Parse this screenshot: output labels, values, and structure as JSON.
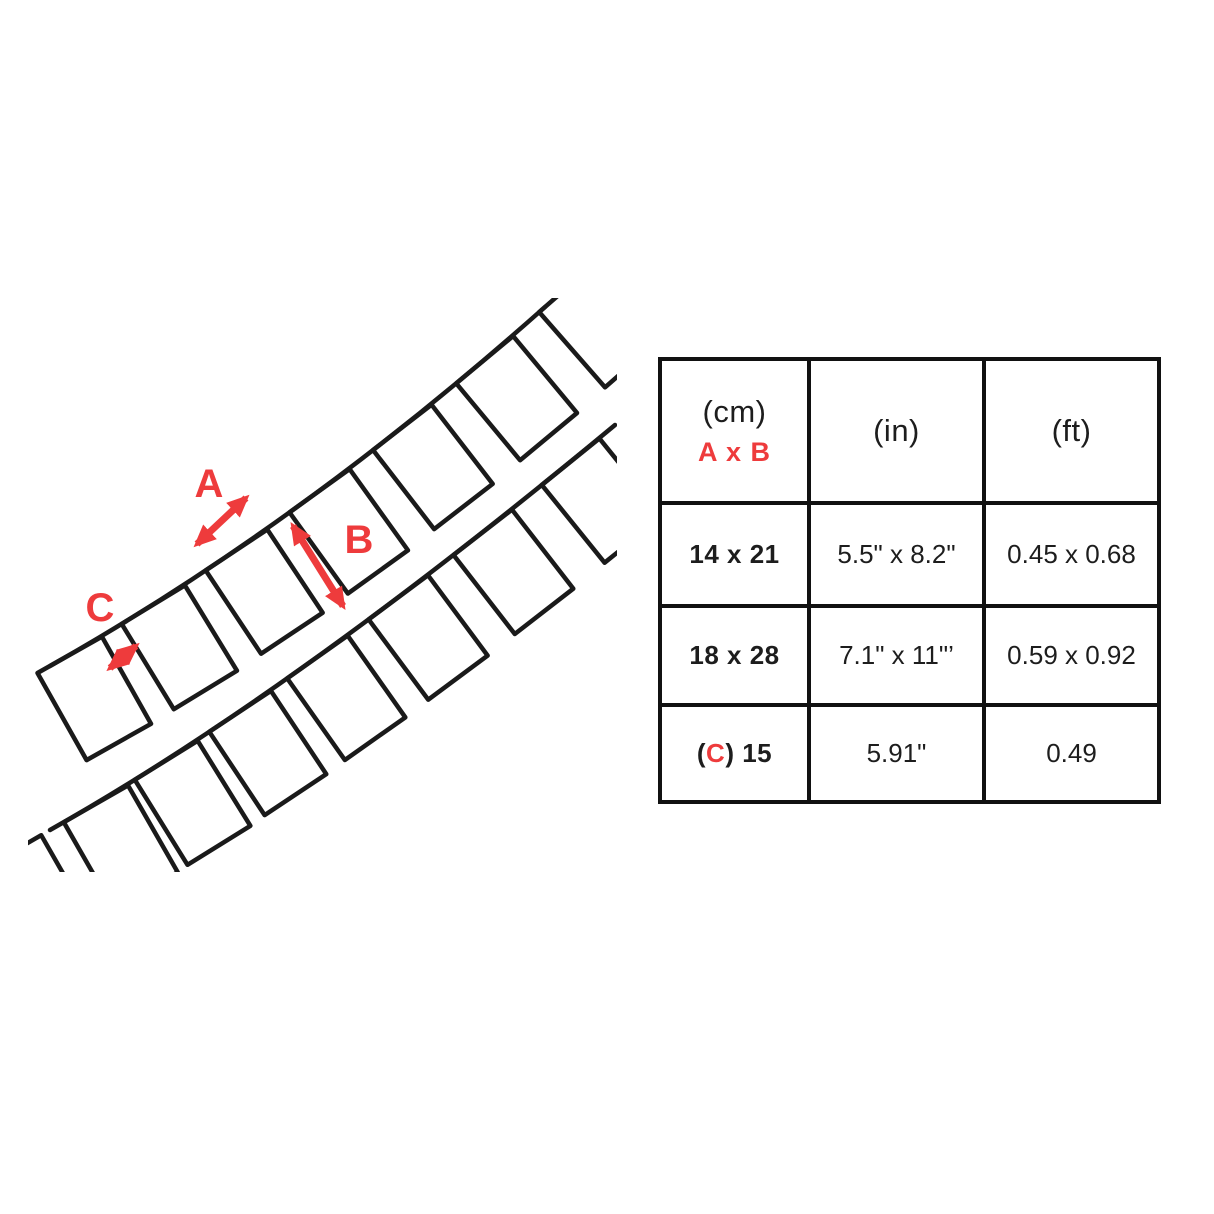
{
  "colors": {
    "accent": "#ee3b3c",
    "ink": "#1a1a1a"
  },
  "diagram": {
    "labels": {
      "a": "A",
      "b": "B",
      "c": "C"
    }
  },
  "table": {
    "header": {
      "col1_unit": "(cm)",
      "col1_dims": "A x B",
      "col2_unit": "(in)",
      "col3_unit": "(ft)"
    },
    "rows": [
      {
        "cm": "14 x 21",
        "in": "5.5\" x 8.2\"",
        "ft": "0.45 x 0.68"
      },
      {
        "cm": "18 x 28",
        "in": "7.1\" x 11\"’",
        "ft": "0.59 x 0.92"
      },
      {
        "cm_prefix": "(",
        "cm_c": "C",
        "cm_suffix": ") 15",
        "in": "5.91\"",
        "ft": "0.49"
      }
    ]
  }
}
